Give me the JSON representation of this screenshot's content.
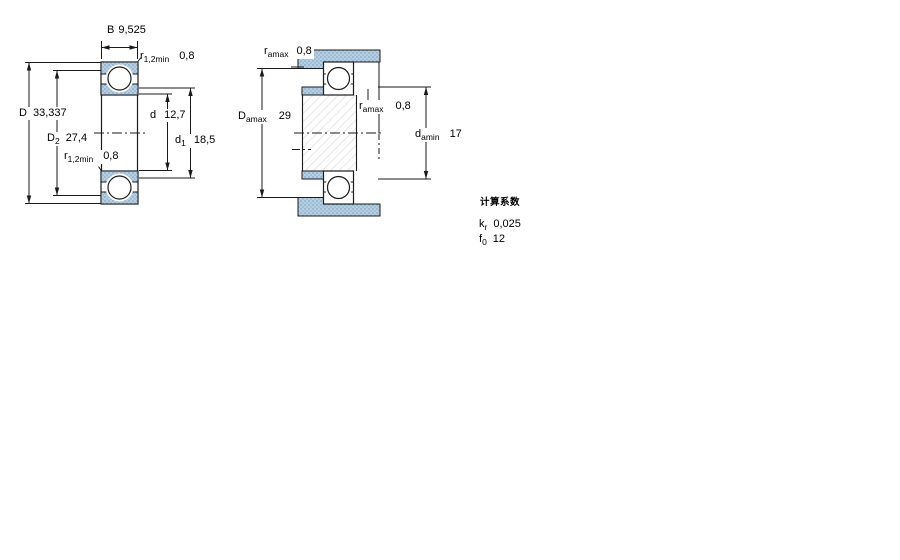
{
  "drawing": {
    "left_view": {
      "description": "bearing cross-section",
      "dims": {
        "B": {
          "sym": "B",
          "value": "9,525"
        },
        "r_top": {
          "sym": "r",
          "sub": "1,2min",
          "value": "0,8"
        },
        "D": {
          "sym": "D",
          "value": "33,337"
        },
        "D2": {
          "sym": "D",
          "sub": "2",
          "value": "27,4"
        },
        "d": {
          "sym": "d",
          "value": "12,7"
        },
        "d1": {
          "sym": "d",
          "sub": "1",
          "value": "18,5"
        },
        "r_bottom": {
          "sym": "r",
          "sub": "1,2min",
          "value": "0,8"
        }
      }
    },
    "right_view": {
      "description": "abutment dimensions with shaft and housing",
      "dims": {
        "r_a_top": {
          "sym": "r",
          "sub": "amax",
          "value": "0,8"
        },
        "D_a": {
          "sym": "D",
          "sub": "amax",
          "value": "29"
        },
        "r_a_mid": {
          "sym": "r",
          "sub": "amax",
          "value": "0,8"
        },
        "d_a": {
          "sym": "d",
          "sub": "amin",
          "value": "17"
        }
      }
    },
    "calculation_factors": {
      "heading": "计算系数",
      "rows": [
        {
          "sym": "k",
          "sub": "r",
          "value": "0,025"
        },
        {
          "sym": "f",
          "sub": "0",
          "value": "12"
        }
      ]
    },
    "colors": {
      "component_fill": "#b7cfe3",
      "component_dot": "#85a8c6",
      "line": "#1a1a1a",
      "hatch": "#e6e6e6"
    }
  }
}
